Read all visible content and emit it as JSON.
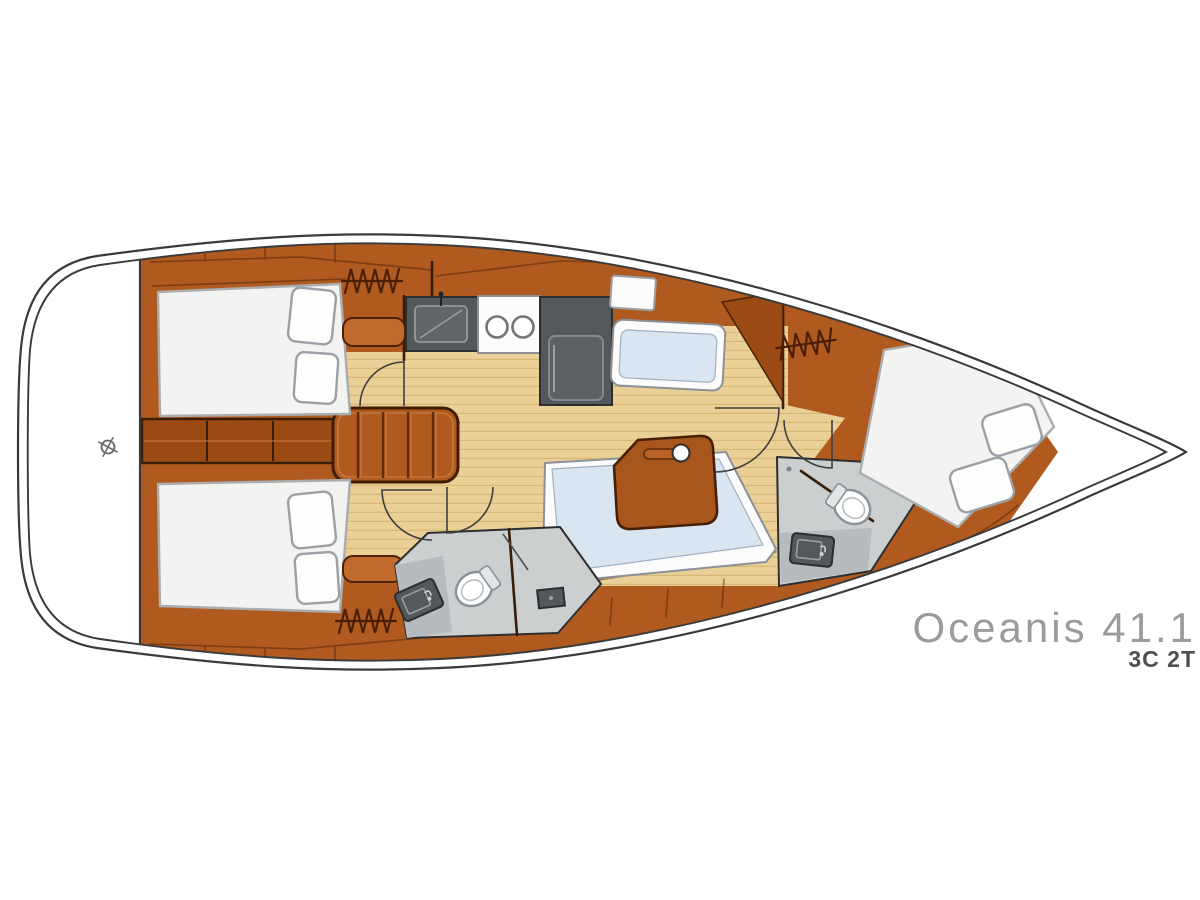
{
  "title": "Oceanis 41.1",
  "subtitle": "3C 2T",
  "icons": {
    "hanging_locker": "zigzag-coil",
    "centerline_mark": "crosshair-circle",
    "door_swing": "quarter-arc",
    "stove": "two-burner-circles",
    "sink": "basin-with-faucet",
    "toilet": "bowl-with-tank"
  },
  "colors": {
    "wood_base": "#b05a20",
    "wood_dark": "#9a4a12",
    "wood_panel": "#c06a2e",
    "wood_outline": "#4a2106",
    "floor": "#ead097",
    "floor_line": "#d8b878",
    "settee": "#d9e6f2",
    "settee_white": "#fcfcfc",
    "bed": "#f3f3f1",
    "pillow_outline": "#9aa0a4",
    "appliance": "#54585b",
    "appliance_dark": "#2b2d2f",
    "head_floor": "#cbcfd0",
    "head_counter": "#b7bbbd",
    "hull_line": "#3a3a3a",
    "symbol": "#4a1f05",
    "text_gray": "#9b9b9b",
    "text_dark": "#4f4f4f"
  }
}
